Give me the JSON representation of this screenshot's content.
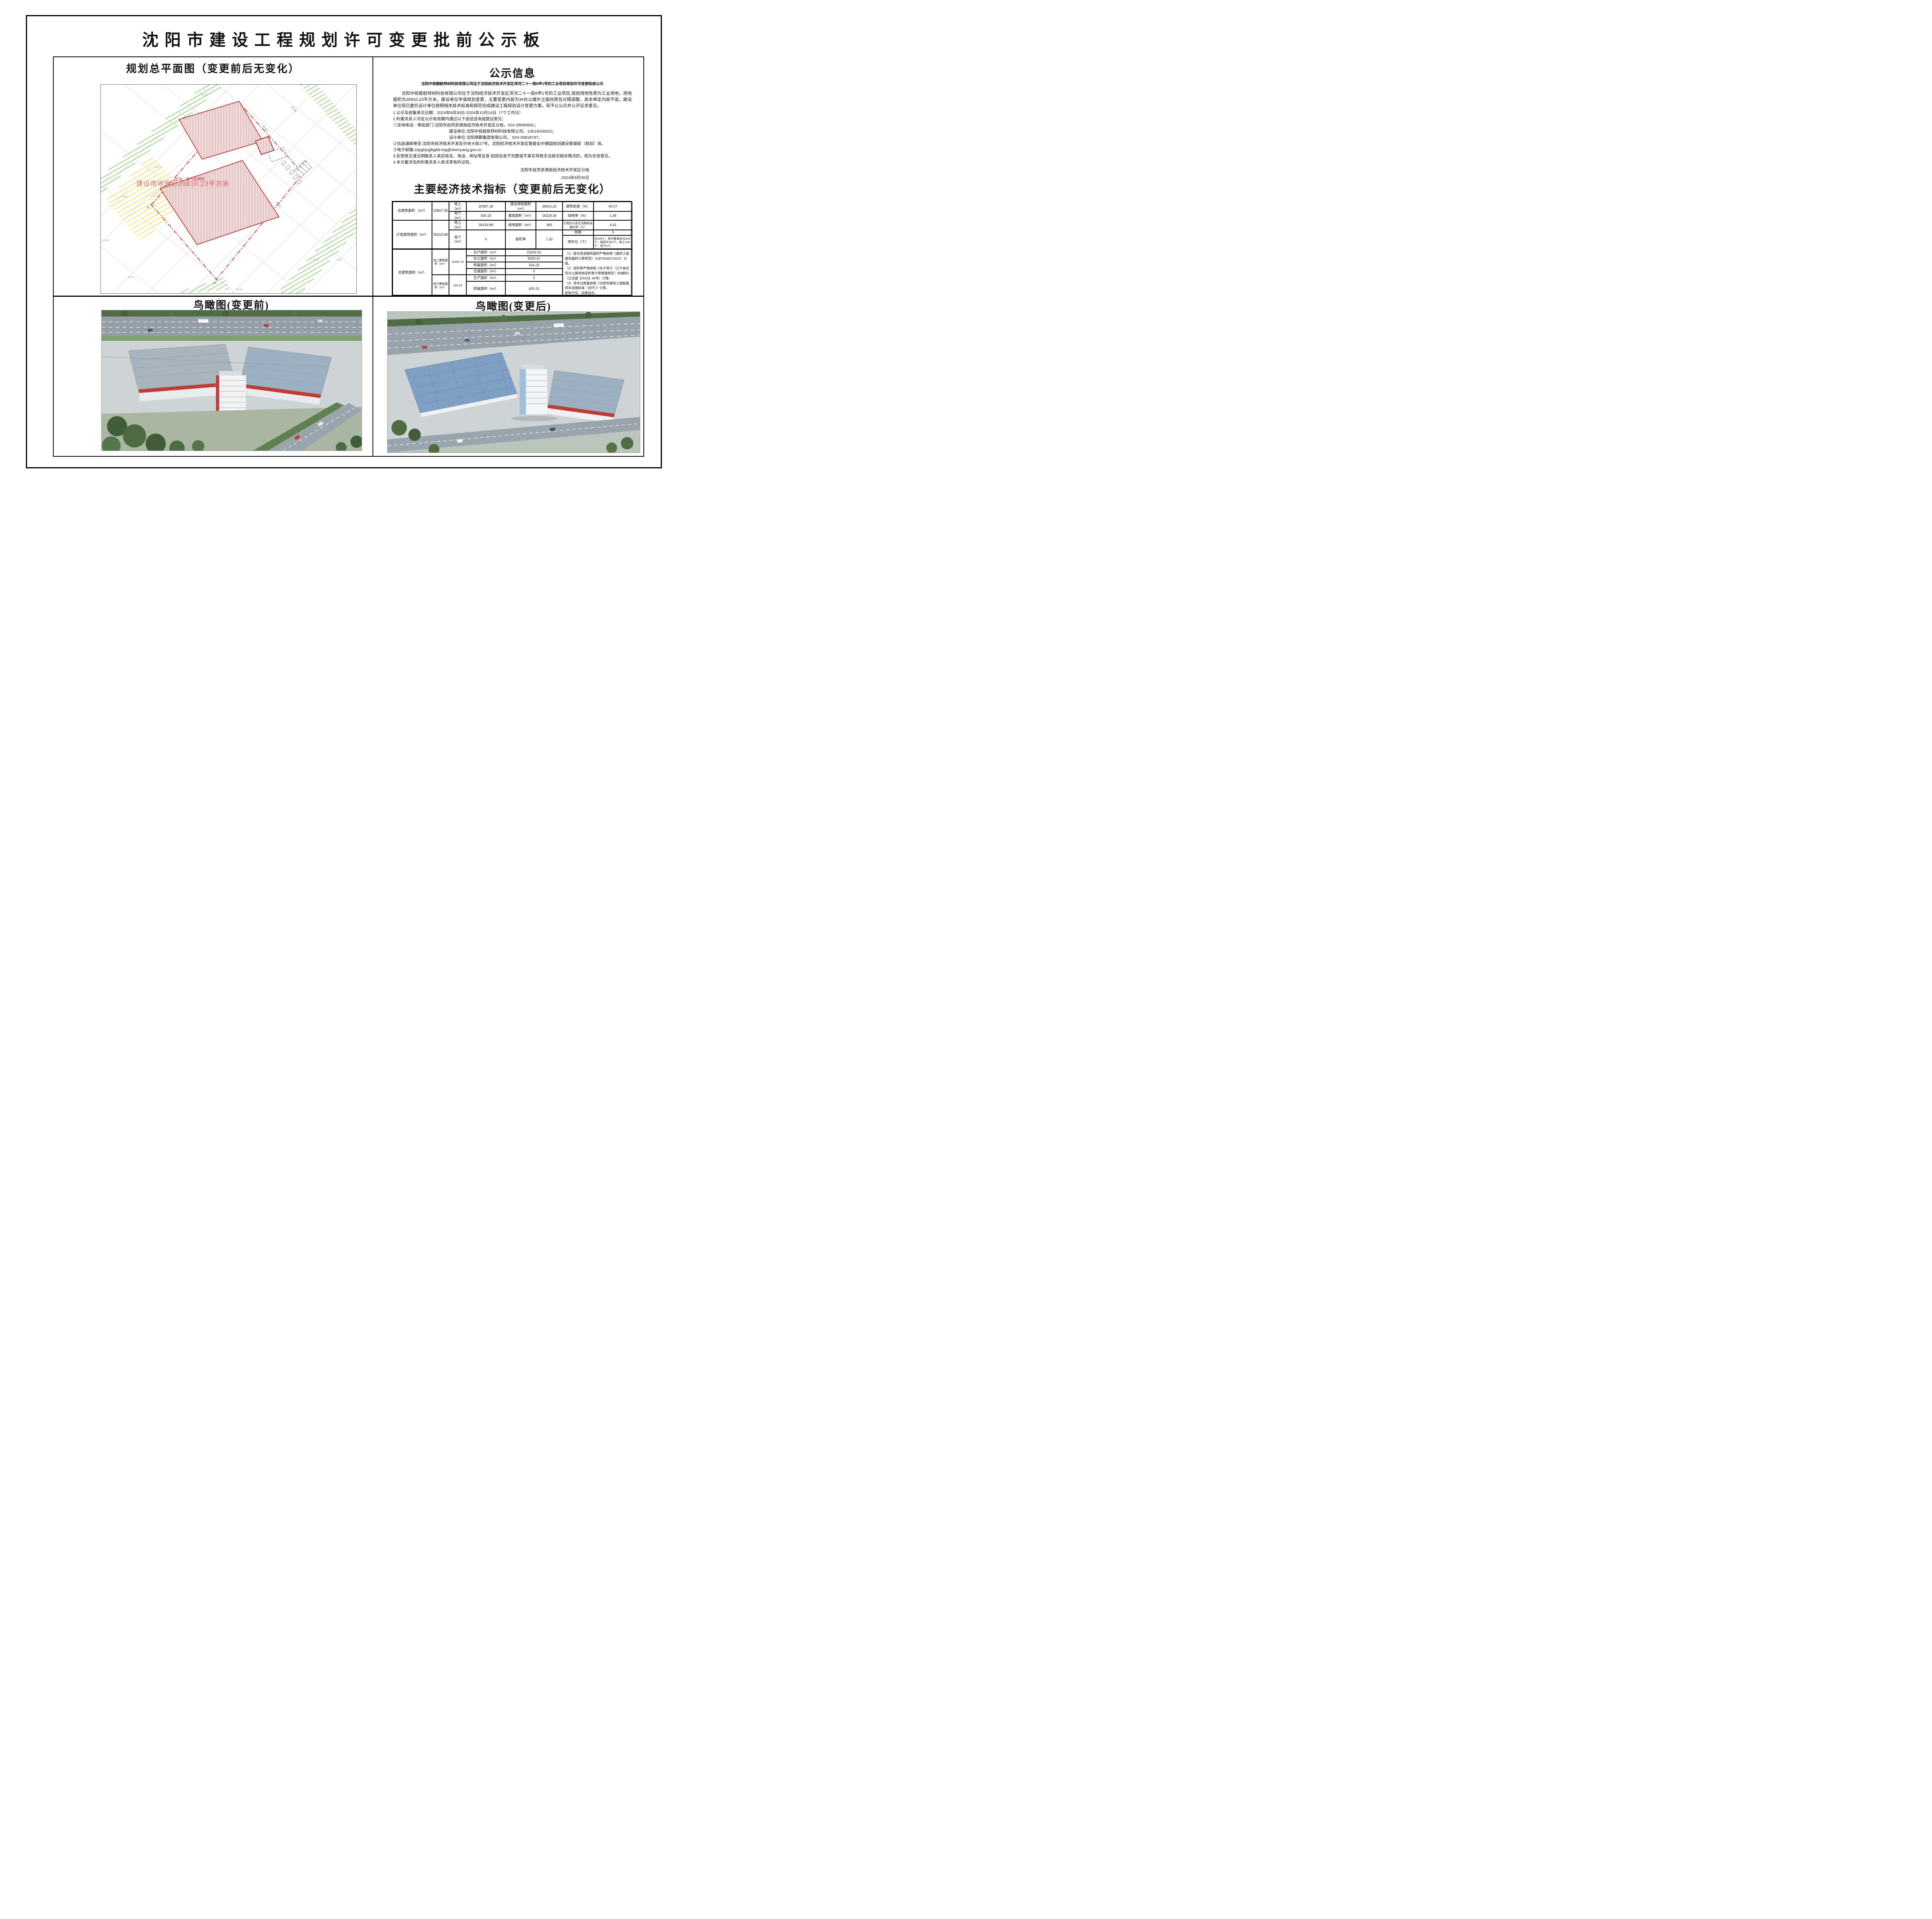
{
  "page": {
    "title": "沈阳市建设工程规划许可变更批前公示板"
  },
  "site_plan": {
    "title": "规划总平面图（变更前后无变化）",
    "area_label": "建设用地面积26910.23平方米",
    "gas_label": "加油、加气站用地",
    "legend": {
      "prefix": "图例:",
      "items": [
        {
          "label": "用地红线",
          "swatch": "red-dashdot-line"
        },
        {
          "label": "新建建筑",
          "swatch": "red-hatch"
        },
        {
          "label": "地下轮廓线",
          "swatch": "blue-dash-line"
        },
        {
          "label": "停车位",
          "swatch": "white-rect"
        }
      ]
    },
    "annotations": [
      "31.93",
      "30.68",
      "30.71",
      "29.45",
      "29.3",
      "30.31",
      "29.93",
      "30.43",
      "28.38",
      "50.80",
      "33.28",
      "16.20",
      "J6",
      "J5",
      "20",
      "21",
      "22",
      "23"
    ]
  },
  "notice": {
    "title": "公示信息",
    "subtitle": "沈阳中核舰航特材科技有限公司位于沈阳经济技术开发区浑河二十一街6甲1号的工业项目规划许可变更批前公示",
    "paragraph": "沈阳中核舰航特材科技有限公司位于沈阳经济技术开发区浑河二十一街6甲1号的工业项目,规划用地性质为工业用地，用地面积为26910.23平方米。建设单位申请规划变更，主要变更内容为3#办公楼外立面材质及分隔调整，其余审定内容不变。建设单位现已委托设计单位按照相关技术标准和规范完成建设工程规划设计变更方案，现予以公示并公开征求意见。",
    "items": [
      "1.公示及收集意见日期：2024年9月30日-2024年10月14日（7个工作日）",
      "2.利害关系人可在公示有效期内通过以下途径咨询或提出意见：",
      "①咨询电话：审批部门:沈阳市自然资源局经济技术开发区分局，024-28690931；",
      "建设单位:沈阳中核舰航特材科技有限公司，13614020022；",
      "设计单位:沈阳祺鹏集团有限公司， 024-25818747。",
      "②信函请邮寄至:沈阳市经济技术开发区中央大街27号，沈阳经济技术开发区管委会中德园规划建设管理部（规划）收。",
      "③电子邮箱:zdyghjsglbghb-txg@shenyang.gov.cn",
      "3.反馈意见请注明联系人真实姓名、电话、地址等信息:如因信息不完整或不真实导致无法核对相关情况的，视为无效意见。",
      "4.本方案涉及的利害关系人依法享有听证权。"
    ],
    "signature": "沈阳市自然资源局经济技术开发区分局",
    "date": "2024年9月30日"
  },
  "indicators": {
    "title": "主要经济技术指标（变更前后无变化）",
    "section1": {
      "total_label": "总建筑面积 （m²）",
      "total_value": "20807.39",
      "above_label": "地上（m²）",
      "above_value": "20387.16",
      "below_label": "地下（m²）",
      "below_value": "420.23",
      "land_label": "建设用地面积（m²）",
      "land_value": "26910.23",
      "density_label": "建筑密度（%）",
      "density_value": "60.27",
      "base_label": "基底面积（m²）",
      "base_value": "16218.35",
      "green_rate_label": "绿地率（%）",
      "green_rate_value": "1.36",
      "capacity_label": "计容建筑面积（m²）",
      "capacity_value": "35419.68",
      "cap_above_label": "地上（m²）",
      "cap_above_value": "35419.68",
      "cap_below_label": "地下（m²）",
      "cap_below_value": "0",
      "green_area_label": "绿地面积（m²）",
      "green_area_value": "365",
      "admin_label": "行政办公及生活服务设施比例（%）",
      "admin_value": "4.41",
      "far_label": "容积率",
      "far_value": "1.32",
      "buildings_label": "栋数",
      "buildings_value": "5",
      "parking_label": "停车位（个）",
      "parking_value": "共106个，其中普通车位104个，装卸车位2个。地上104个，地下0个。"
    },
    "section2": {
      "total_label": "总建筑面积（m²）",
      "above_label": "地上建筑面积（m²）",
      "above_value": "20387.16",
      "below_label": "地下建筑面积（m²）",
      "below_value": "420.23",
      "rows_above": [
        {
          "label": "生产面积（m²）",
          "value": "15032.52"
        },
        {
          "label": "办公面积（m²）",
          "value": "5030.41"
        },
        {
          "label": "附属面积（m²）",
          "value": "324.23"
        },
        {
          "label": "仓储面积（m²）",
          "value": "0"
        }
      ],
      "rows_below": [
        {
          "label": "生产面积（m²）",
          "value": "0"
        },
        {
          "label": "附属面积（m²）",
          "value": "420.23"
        }
      ],
      "notes": "（1）我司承诺建筑面积严格依照《建筑工程建筑面积计算规范》（GBT50353-2013）计算。\n（2）容积率严格依照《关于修订〈辽宁省住宅与公建用地容积率计算管理规定〉的通知》（辽住建【2015】94号）计算。\n（3）停车位数量依照《沈阳市建筑工程配建停车设施标准（试行）》计算。\n如有不实，后果自负。"
    }
  },
  "views": {
    "before_label": "鸟瞰图(变更前)",
    "after_label": "鸟瞰图(变更后)"
  },
  "colors": {
    "red_line": "#e02020",
    "red_hatch": "#e03030",
    "green_hatch": "#82cc66",
    "yellow_hatch": "#f2e04a",
    "blue_dash": "#2b7bd4",
    "ink": "#111111"
  }
}
